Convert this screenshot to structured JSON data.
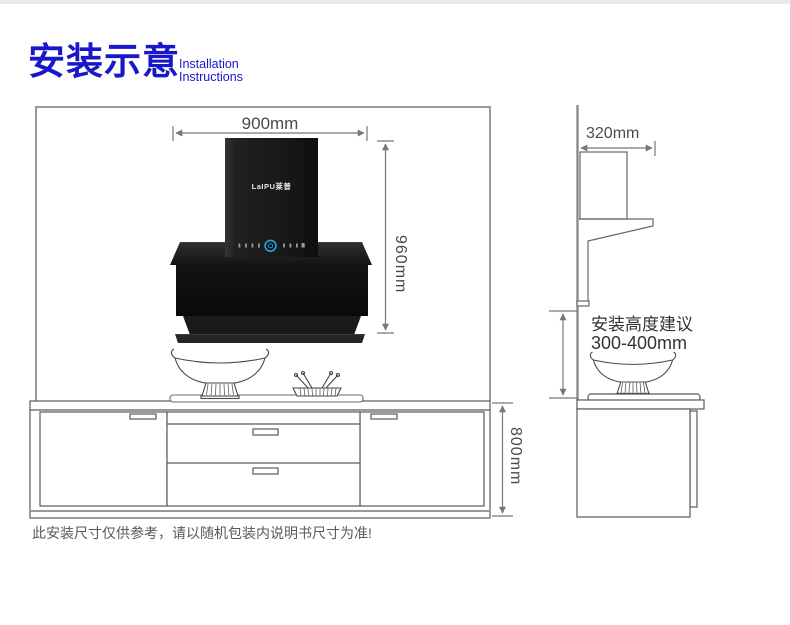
{
  "header": {
    "title_cn": "安装示意",
    "subtitle_line1": "Installation",
    "subtitle_line2": "Instructions",
    "accent_color": "#1818ca"
  },
  "front_view": {
    "width_label": "900mm",
    "height_label": "960mm",
    "counter_height_label": "800mm",
    "logo": "LaIPU莱普"
  },
  "side_view": {
    "depth_label": "320mm",
    "advice_line1": "安装高度建议",
    "advice_line2": "300-400mm"
  },
  "footnote": "此安装尺寸仅供参考，请以随机包装内说明书尺寸为准!",
  "colors": {
    "dimension_line": "#777777",
    "drawing_line": "#5a5a5a",
    "hood_black": "#141414",
    "control_blue": "#2fa3dc"
  }
}
